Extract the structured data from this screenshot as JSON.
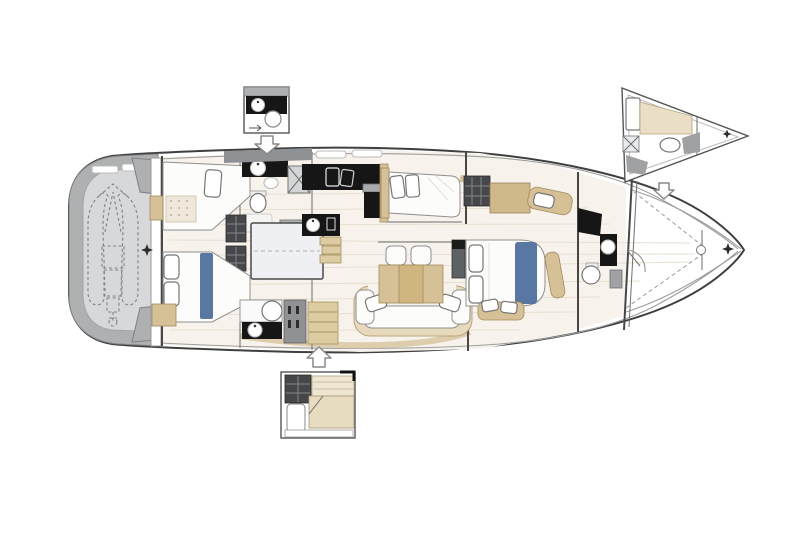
{
  "diagram": {
    "kind": "sailing-yacht-interior-deck-plan",
    "orientation": "bow-right",
    "visible_text_present": false
  },
  "colors": {
    "background": "#ffffff",
    "hull_line": "#3f3f3f",
    "inner_line": "#9e9e9e",
    "deck_gray": "#aeb0b2",
    "deck_gray_light": "#d7d8da",
    "hatch_gray": "#8f9294",
    "floor": "#f7f3ec",
    "floor_line": "#e7e0d1",
    "beige": "#d6c095",
    "beige_light": "#eadfc6",
    "wood_step": "#ddcba2",
    "counter_black": "#161616",
    "accent_blue": "#5878a3",
    "cabinet_dark": "#45474a",
    "cabinet_gray": "#8f9194",
    "cushion_white": "#fcfcfa",
    "arrow_fill": "#ffffff",
    "arrow_stroke": "#8a8a8a",
    "dashed_line": "#808284"
  },
  "icons": {
    "down_arrow": "⇩",
    "up_arrow": "⇧",
    "four_point_star": "✦",
    "cross_hatch": "✕"
  },
  "regions": {
    "main_plan": [
      "stern-swim-platform",
      "tender-garage",
      "port-aft-cabin",
      "port-aft-head",
      "companionway-engine-box",
      "galley",
      "guest-cabin-berth",
      "salon",
      "starboard-aft-cabin",
      "starboard-aft-head",
      "owner-cabin",
      "forward-head",
      "forepeak-sail-locker",
      "bow"
    ],
    "option_insets": [
      "midship-head-option-inset",
      "bow-crew-cabin-option-inset",
      "aft-cabin-option-inset"
    ]
  }
}
